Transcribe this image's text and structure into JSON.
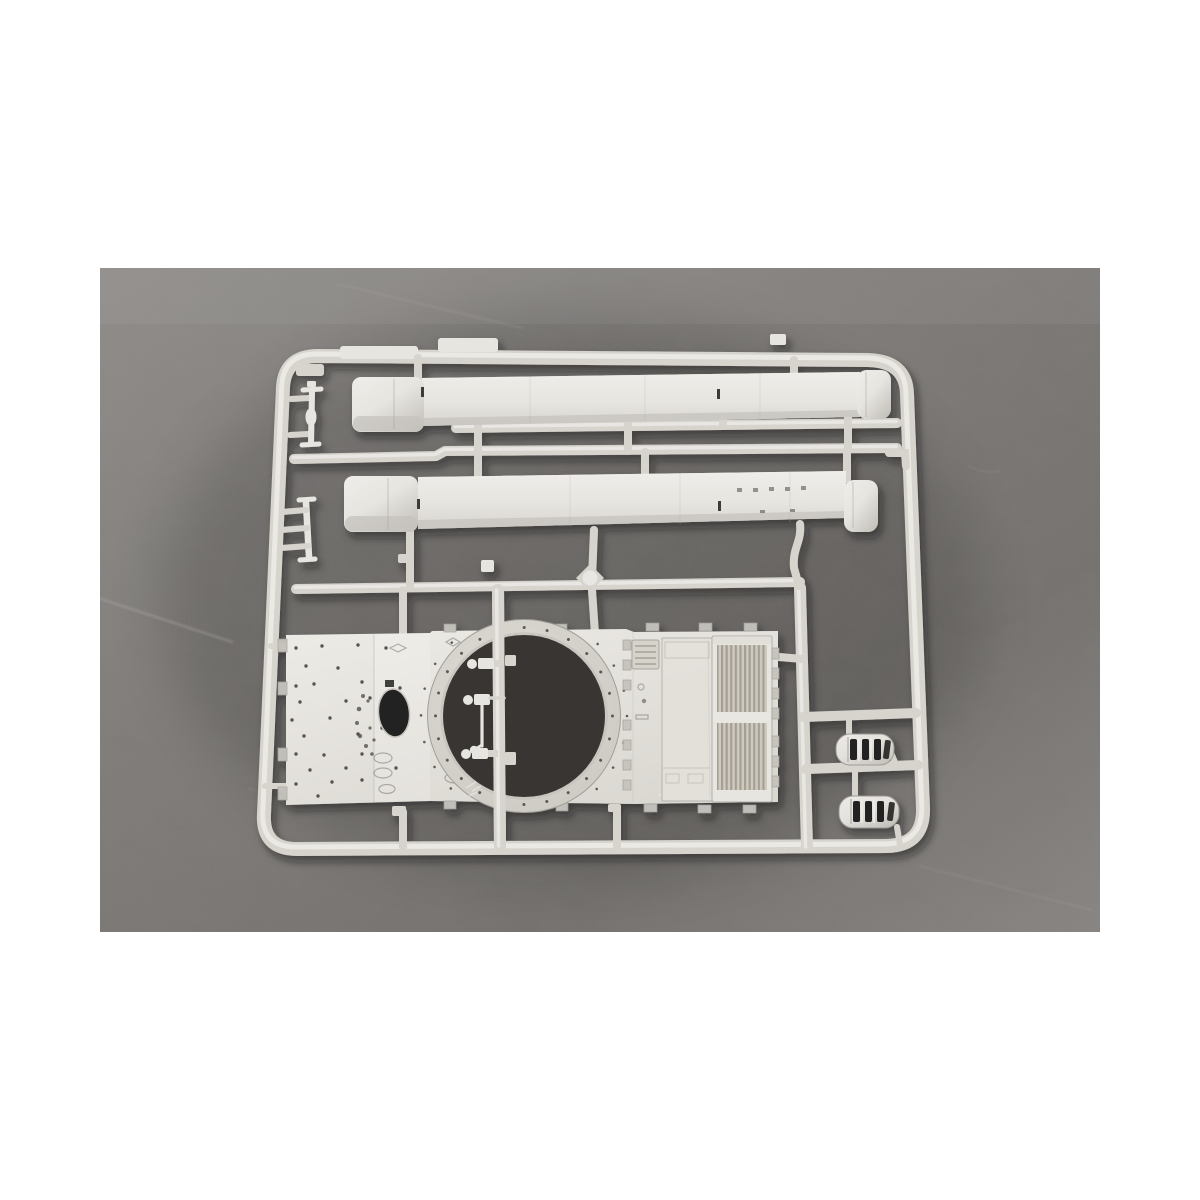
{
  "meta": {
    "type": "product-photograph",
    "description": "Photograph of a light grey injection-moulded plastic model kit sprue lying on dark grey felt, framed by white page margins",
    "alt": "Sprue of light grey plastic model parts: two long side-skirt strips, a tank hull roof plate with a circular turret-ring opening, an engine deck with intake grilles, two slotted exhaust mufflers and several small fittings, all attached to a rectangular runner frame on a dark grey fabric background"
  },
  "colors": {
    "page_bg": "#ffffff",
    "bg_light": "#8d8a87",
    "bg_mid": "#7b7875",
    "bg_deep": "#716e6b",
    "bg_edge": "#858280",
    "plastic": "#d7d4ce",
    "plastic_hi": "#efede9",
    "plastic_bright": "#e7e5e0",
    "plastic_mid": "#c6c3bd",
    "plastic_shadow": "#a29f99",
    "hole_dark": "#232120",
    "pit_dark": "#373431",
    "dot_dark": "#3e3c38",
    "slat_light": "#cfcabf",
    "slat_dark": "#a49e93",
    "streak": "#b4b1ad",
    "cast_shadow": "#16140f"
  },
  "parts": [
    {
      "name": "runner-frame",
      "label": "Rectangular sprue runner frame"
    },
    {
      "name": "upper-side-skirt",
      "label": "Long side-skirt strip (upper)"
    },
    {
      "name": "lower-side-skirt",
      "label": "Long side-skirt strip (lower)"
    },
    {
      "name": "turnbuckle-fitting",
      "label": "Small turnbuckle fitting on left runner"
    },
    {
      "name": "ladder-fitting",
      "label": "Small ladder-shaped fitting on left runner"
    },
    {
      "name": "hull-roof-plate",
      "label": "Hull roof plate with rivet holes and oval opening"
    },
    {
      "name": "turret-ring-opening",
      "label": "Circular turret-ring opening with bolt holes"
    },
    {
      "name": "engine-deck",
      "label": "Engine deck with slatted intake grilles"
    },
    {
      "name": "exhaust-muffler-upper",
      "label": "Slotted exhaust muffler (upper)"
    },
    {
      "name": "exhaust-muffler-lower",
      "label": "Slotted exhaust muffler (lower)"
    },
    {
      "name": "periscope-fittings",
      "label": "Small periscope fittings inside turret ring"
    },
    {
      "name": "inner-runners",
      "label": "Internal runner bars and feed gates"
    }
  ]
}
